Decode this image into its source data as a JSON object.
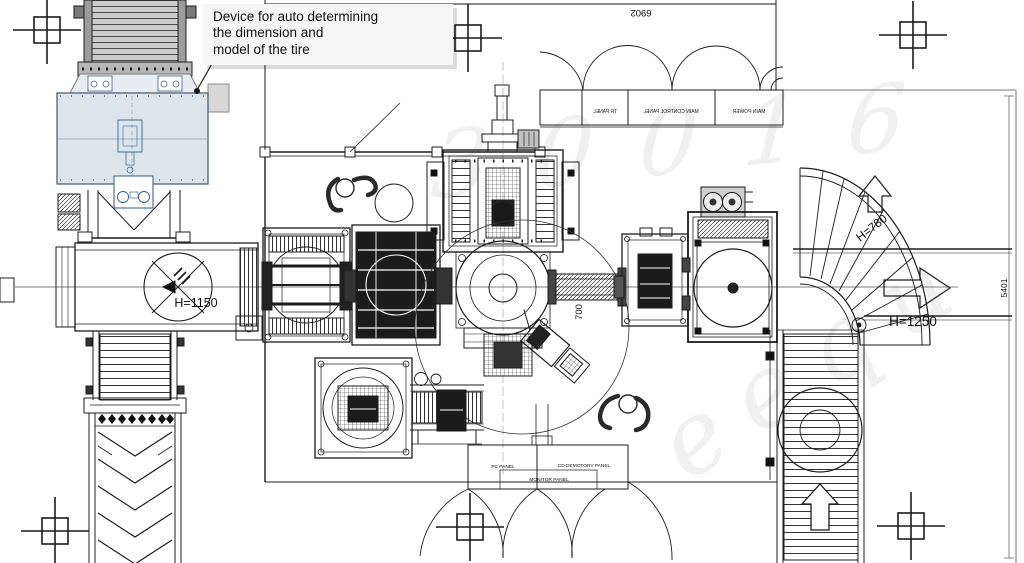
{
  "callout": {
    "line1": "Device for auto determining",
    "line2": "the dimension and",
    "line3": "model of the tire"
  },
  "top_panels": {
    "items": [
      {
        "label": "TR PANEL"
      },
      {
        "label": "MAIN CONTROL PANEL"
      },
      {
        "label": "MAIN POWER"
      }
    ]
  },
  "control_panels": {
    "pc_label": "PC PANEL",
    "monitor_label": "MONITOR PANEL",
    "demotory_label": "CD DEMOTORY PANEL"
  },
  "dimensions": {
    "top_width": "6902",
    "right_height": "5401",
    "center_gap": "700",
    "left_conveyor_height": "H=1150",
    "right_conveyor_height": "H=1250",
    "turn_conveyor_height": "H=780"
  },
  "watermark": {
    "fragment_a": "30016",
    "fragment_b": "eequ"
  },
  "colors": {
    "line": "#1c1c1c",
    "dim_line": "#8a8a8a",
    "device_fill": "#dde5ec",
    "device_stroke": "#39648c",
    "callout_bg": "#f6f6f6"
  }
}
